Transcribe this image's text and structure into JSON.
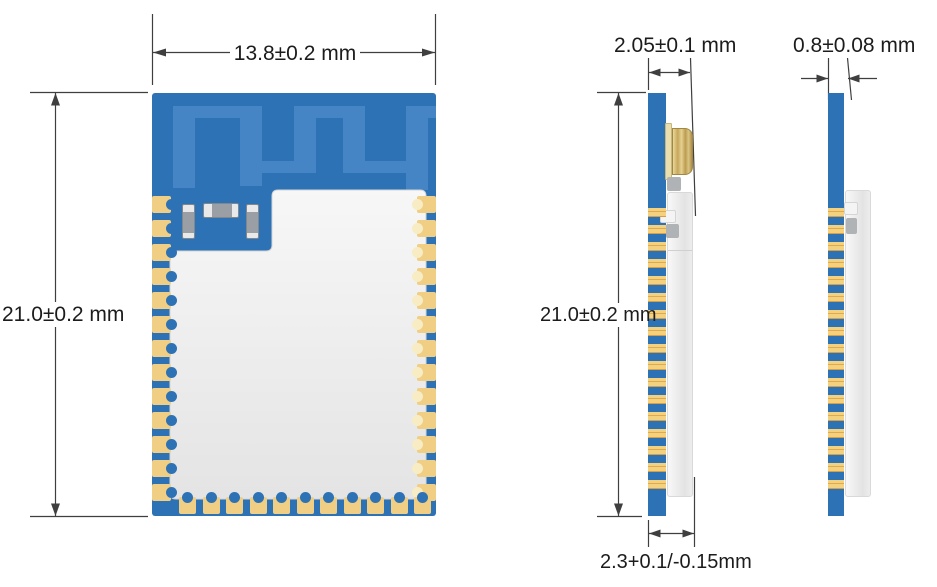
{
  "diagram": {
    "front": {
      "width_dim": "13.8±0.2 mm",
      "height_dim": "21.0±0.2 mm"
    },
    "side": {
      "thickness_dim": "2.05±0.1 mm",
      "height_dim": "21.0±0.2 mm",
      "pad_dim": "2.3+0.1/-0.15mm"
    },
    "edge": {
      "thickness_dim": "0.8±0.08 mm"
    }
  },
  "module": {
    "pad_counts": {
      "left": 13,
      "right": 13,
      "bottom": 11
    },
    "colors": {
      "board": "#2E72B6",
      "antenna_trace": "#4585C5",
      "pad_gold": "#F0CE84",
      "pad_gold_dark": "#DFA94F",
      "shield": "#ECECEC",
      "connector": "#C9AC5C",
      "line": "#3F3F3F",
      "text": "#1C1C1C"
    }
  }
}
